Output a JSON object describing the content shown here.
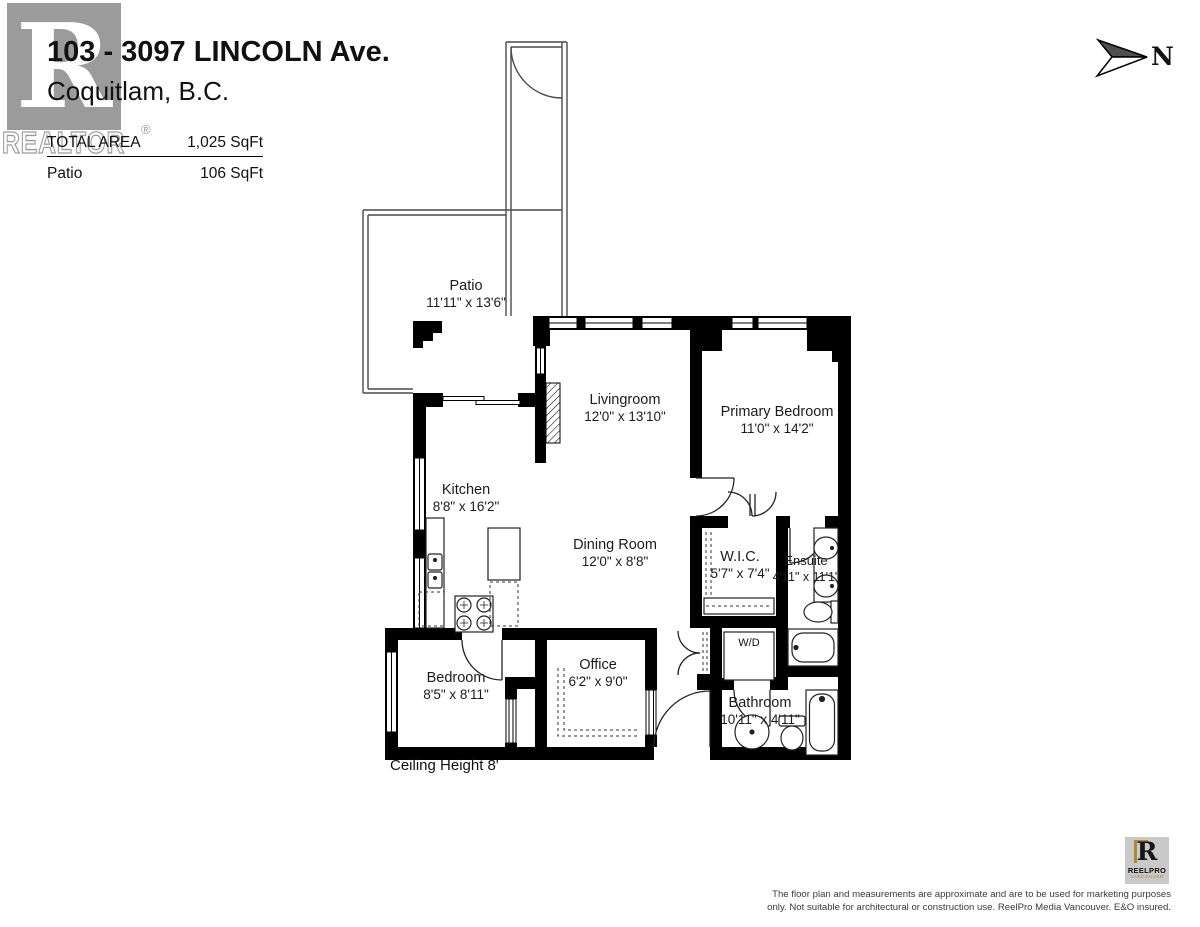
{
  "header": {
    "address_line1": "103 - 3097 LINCOLN Ave.",
    "address_line2": "Coquitlam, B.C.",
    "total_area_label": "TOTAL AREA",
    "total_area_value": "1,025 SqFt",
    "patio_label": "Patio",
    "patio_value": "106 SqFt"
  },
  "watermark": {
    "letter": "R",
    "word": "REALTOR",
    "registered": "®"
  },
  "compass": {
    "label": "N"
  },
  "rooms": [
    {
      "name": "Patio",
      "dims": "11'11\" x 13'6\""
    },
    {
      "name": "Livingroom",
      "dims": "12'0\" x 13'10\""
    },
    {
      "name": "Primary Bedroom",
      "dims": "11'0\" x 14'2\""
    },
    {
      "name": "Kitchen",
      "dims": "8'8\" x 16'2\""
    },
    {
      "name": "Dining Room",
      "dims": "12'0\" x 8'8\""
    },
    {
      "name": "W.I.C.",
      "dims": "5'7\" x 7'4\""
    },
    {
      "name": "Ensuite",
      "dims": "4'11\" x 11'1\""
    },
    {
      "name": "Bedroom",
      "dims": "8'5\" x 8'11\""
    },
    {
      "name": "Office",
      "dims": "6'2\" x 9'0\""
    },
    {
      "name": "Bathroom",
      "dims": "10'11\" x 4'11\""
    }
  ],
  "annotations": {
    "washer_dryer": "W/D",
    "ceiling_height": "Ceiling Height  8'"
  },
  "footer": {
    "logo_letter": "R",
    "logo_title": "REELPRO",
    "logo_subtitle": "VANCOUVER",
    "disclaimer_line1": "The floor plan and measurements are approximate and are to be used for marketing purposes",
    "disclaimer_line2": "only. Not suitable for architectural or construction use. ReelPro Media Vancouver. E&O insured."
  },
  "colors": {
    "wall": "#000000",
    "watermark_gray": "#9b9b9b",
    "logo_gold": "#b08830",
    "logo_gray": "#c9c9c9"
  }
}
